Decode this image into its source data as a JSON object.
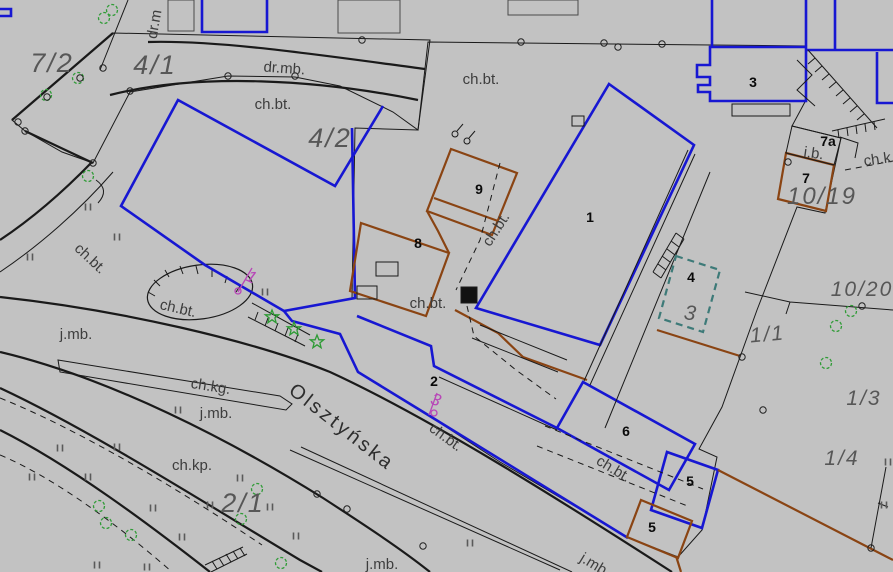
{
  "map_type": "cadastral-survey-map",
  "colors": {
    "background": "#c2c2c2",
    "parcel_highlight": "#fbf89e",
    "boundary_blue": "#1717d2",
    "boundary_brown": "#8a4413",
    "line_black": "#1a1a1a",
    "marker_magenta": "#b847b8",
    "vegetation_green": "#2e9b35",
    "dashed_teal": "#3d7a78"
  },
  "street": {
    "name": "Olsztyńska"
  },
  "labels": {
    "parcels": [
      {
        "text": "7/2"
      },
      {
        "text": "4/1"
      },
      {
        "text": "4/2"
      },
      {
        "text": "2/1"
      },
      {
        "text": "1/1"
      },
      {
        "text": "1/3"
      },
      {
        "text": "1/4"
      },
      {
        "text": "10/19"
      },
      {
        "text": "10/20"
      },
      {
        "text": "3"
      }
    ],
    "buildings": [
      {
        "text": "1"
      },
      {
        "text": "2"
      },
      {
        "text": "3"
      },
      {
        "text": "4"
      },
      {
        "text": "5"
      },
      {
        "text": "5"
      },
      {
        "text": "6"
      },
      {
        "text": "7"
      },
      {
        "text": "7a"
      },
      {
        "text": "8"
      },
      {
        "text": "9"
      }
    ],
    "surface": [
      {
        "text": "dr.mb."
      },
      {
        "text": "dr.m"
      },
      {
        "text": "ch.bt."
      },
      {
        "text": "ch.bt."
      },
      {
        "text": "ch.bt."
      },
      {
        "text": "ch.bt."
      },
      {
        "text": "ch.bt."
      },
      {
        "text": "ch.bt."
      },
      {
        "text": "ch.bt."
      },
      {
        "text": "ch.bt."
      },
      {
        "text": "j.mb."
      },
      {
        "text": "j.mb."
      },
      {
        "text": "j.mb."
      },
      {
        "text": "j.mb"
      },
      {
        "text": "ch.kg."
      },
      {
        "text": "ch.kp."
      },
      {
        "text": "ch.k"
      },
      {
        "text": "i.b."
      }
    ],
    "markers": [
      {
        "text": "1"
      },
      {
        "text": "3"
      }
    ]
  }
}
